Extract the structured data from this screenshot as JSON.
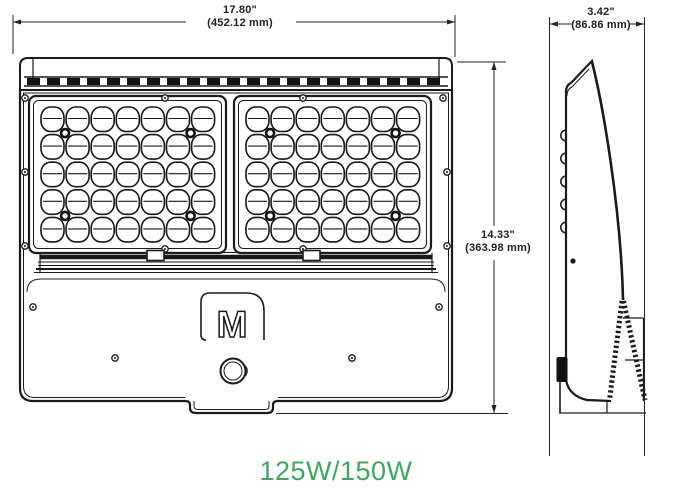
{
  "dimensions": {
    "width": {
      "inches": "17.80\"",
      "metric": "(452.12 mm)"
    },
    "height": {
      "inches": "14.33\"",
      "metric": "(363.98 mm)"
    },
    "depth": {
      "inches": "3.42\"",
      "metric": "(86.86 mm)"
    }
  },
  "product": {
    "wattage_label": "125W/150W",
    "logo_letter": "M"
  },
  "front_view": {
    "led_grid": {
      "panels": 2,
      "rows": 5,
      "columns": 7,
      "leds_per_panel": 35,
      "total_leds": 70
    }
  },
  "colors": {
    "line": "#1a1a1a",
    "wattage_green": "#3BA95C",
    "dimension_text": "#1f1f1f",
    "background": "#ffffff"
  }
}
